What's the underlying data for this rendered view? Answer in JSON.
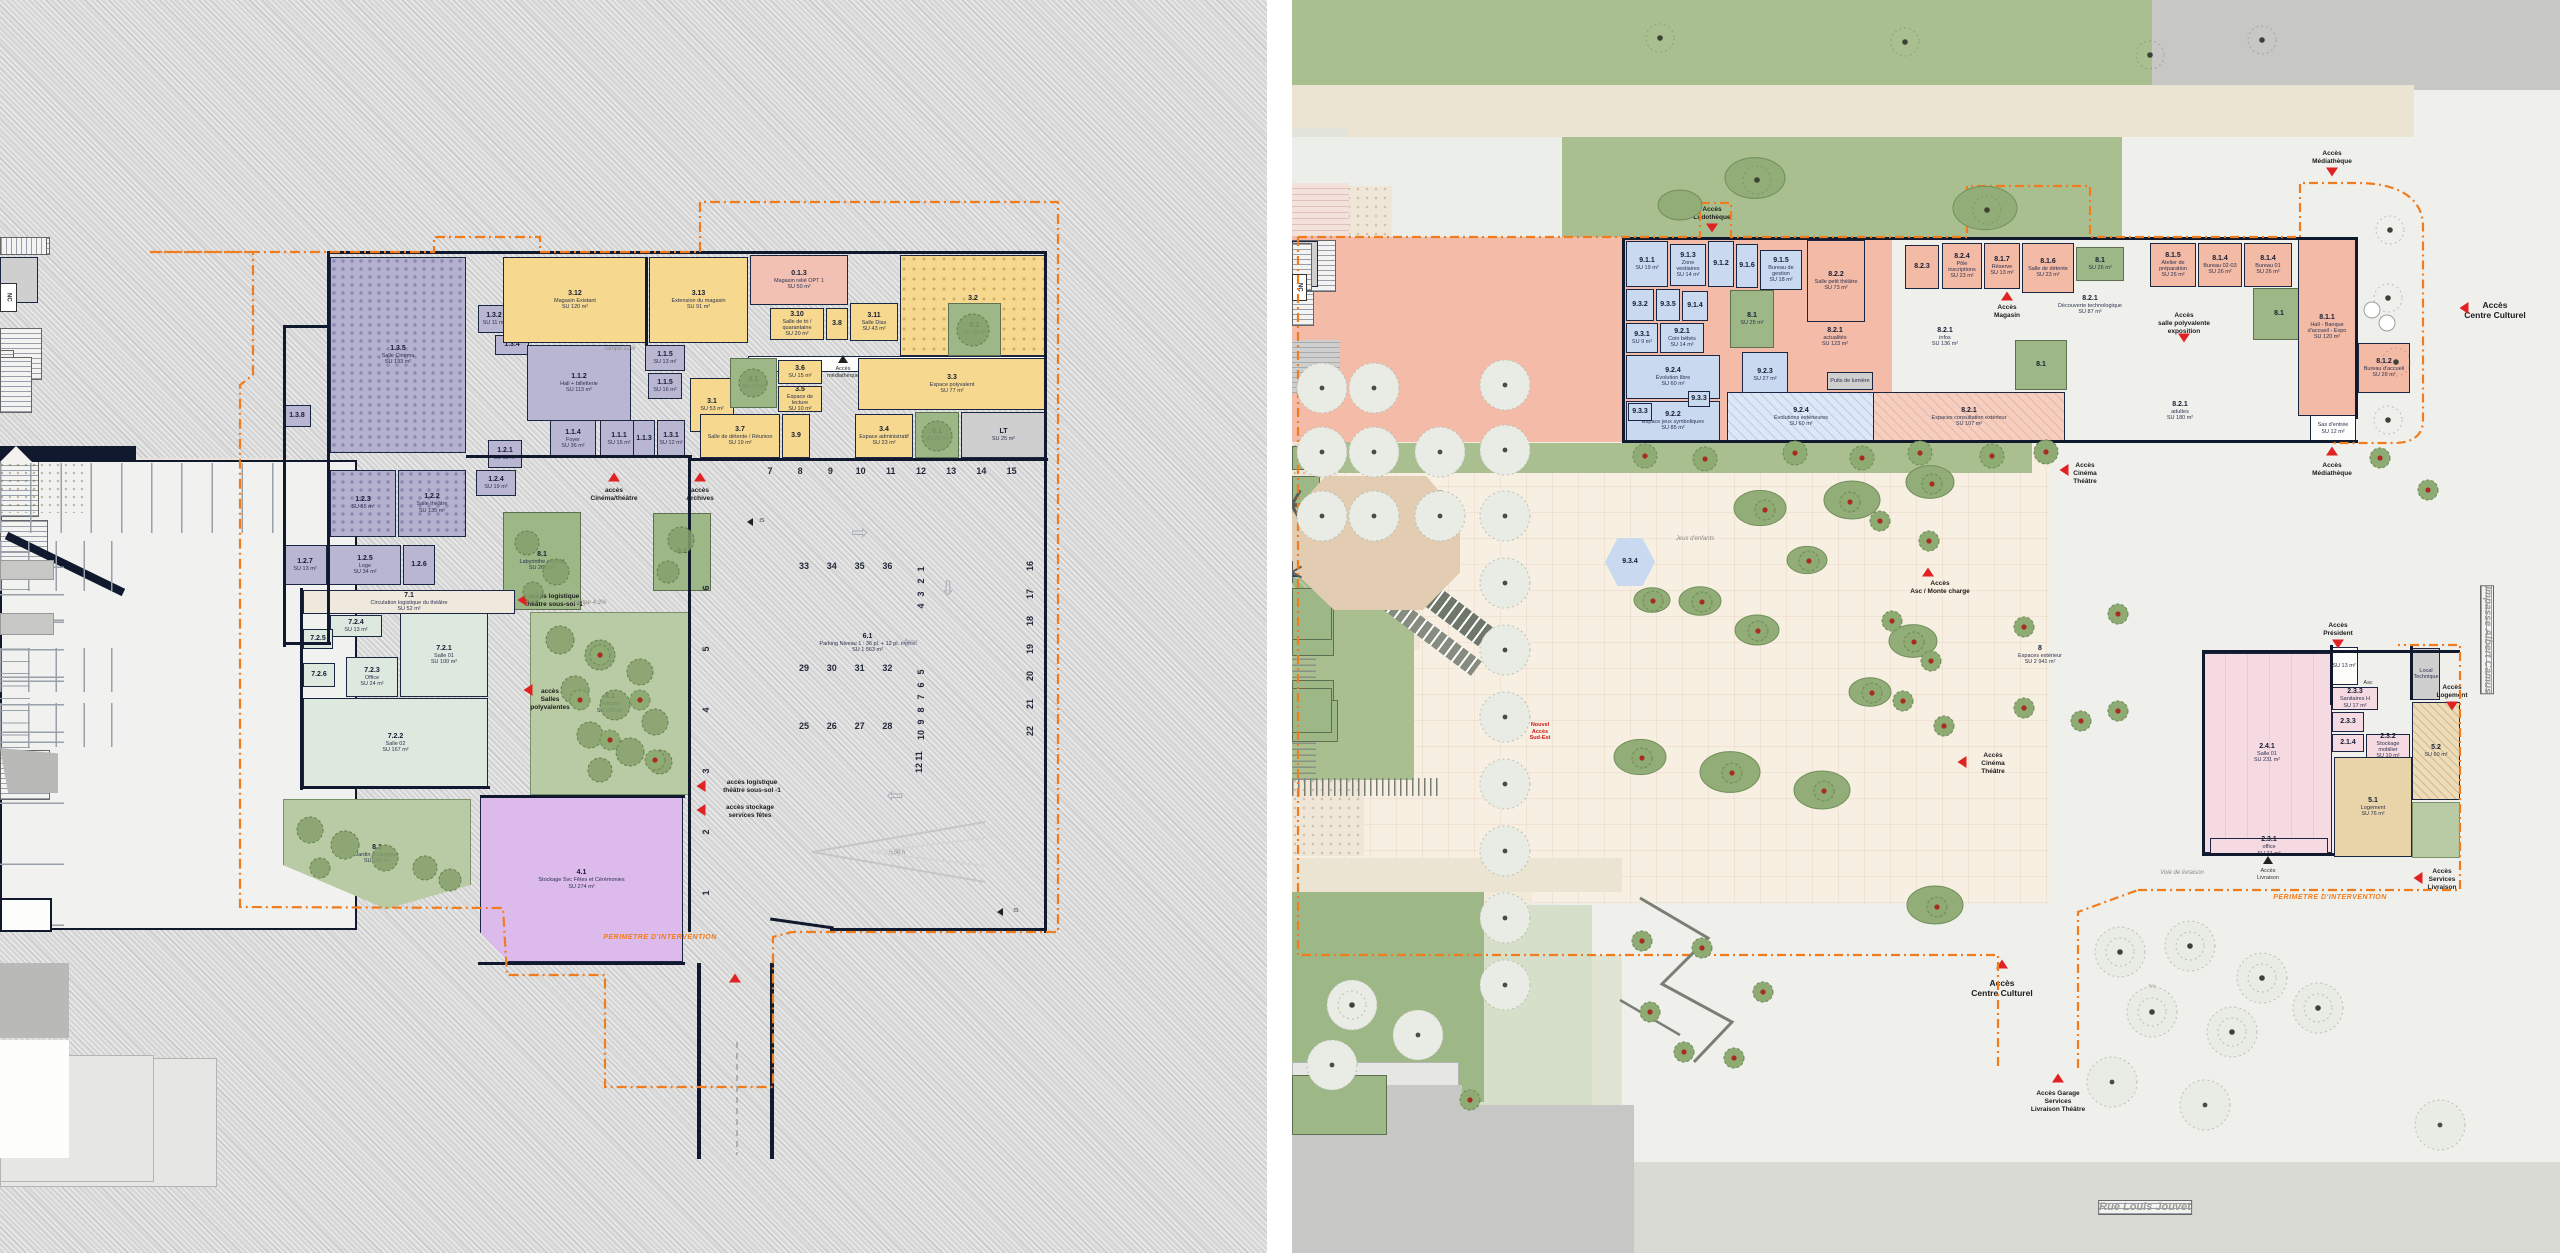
{
  "colors": {
    "accent_orange": "#f07c1e",
    "access_red": "#e02222",
    "wall": "#10192e",
    "purple": "#b9b6d2",
    "yellow": "#f6d88e",
    "salmon": "#f3baa6",
    "blue": "#c9d9f0",
    "green_room": "#dde8de",
    "violet": "#dcbaeb",
    "patio_green": "#9db786",
    "pink": "#f3c1b4"
  },
  "left_plan": {
    "rooms": {
      "r135": {
        "id": "1.3.5",
        "name": "Salle Cinéma",
        "area": "SU 193 m²"
      },
      "r123": {
        "id": "1.2.3",
        "name": "",
        "area": "SU 65 m²"
      },
      "r122": {
        "id": "1.2.2",
        "name": "Salle théâtre",
        "area": "SU 135 m²"
      },
      "r132": {
        "id": "1.3.2",
        "name": "Régie",
        "area": "SU 11 m²"
      },
      "r134": {
        "id": "1.3.4",
        "name": "",
        "area": "SU 11 m²"
      },
      "r138": {
        "id": "1.3.8",
        "name": "",
        "area": "SU 9 m²"
      },
      "r112": {
        "id": "1.1.2",
        "name": "Hall + billetterie",
        "area": "SU 113 m²"
      },
      "r115a": {
        "id": "1.1.5",
        "name": "Vestiaires",
        "area": "SU 13 m²"
      },
      "r115b": {
        "id": "1.1.5",
        "name": "Sanitaires",
        "area": "SU 16 m²"
      },
      "r114": {
        "id": "1.1.4",
        "name": "Foyer",
        "area": "SU 36 m²"
      },
      "r111": {
        "id": "1.1.1",
        "name": "Sas d'entrée",
        "area": "SU 15 m²"
      },
      "r113": {
        "id": "1.1.3",
        "name": "Sanitaires",
        "area": "SU 13 m²"
      },
      "r131": {
        "id": "1.3.1",
        "name": "Bureau association",
        "area": "SU 12 m²"
      },
      "r121": {
        "id": "1.2.1",
        "name": "Sas d'entrée",
        "area": "SU 12 m²"
      },
      "r124": {
        "id": "1.2.4",
        "name": "Régie",
        "area": "SU 19 m²"
      },
      "r127": {
        "id": "1.2.7",
        "name": "Stock",
        "area": "SU 13 m²"
      },
      "r125": {
        "id": "1.2.5",
        "name": "Loge",
        "area": "SU 34 m²"
      },
      "r126": {
        "id": "1.2.6",
        "name": "",
        "area": "SU 9 m²"
      },
      "y312": {
        "id": "3.12",
        "name": "Magasin Existant",
        "area": "SU 120 m²"
      },
      "y313": {
        "id": "3.13",
        "name": "Extension du magasin",
        "area": "SU 91 m²"
      },
      "p013": {
        "id": "0.1.3",
        "name": "Magasin relié OPT 1",
        "area": "SU 50 m²"
      },
      "y310": {
        "id": "3.10",
        "name": "Salle de tri / quarantaine",
        "area": "SU 20 m²"
      },
      "y38": {
        "id": "3.8",
        "name": "Stock / Régie",
        "area": "SU 7 m²"
      },
      "y311": {
        "id": "3.11",
        "name": "Salle Dias",
        "area": "SU 43 m²"
      },
      "y32": {
        "id": "3.2",
        "name": "Espace d'exposition",
        "area": "SU 129 m²"
      },
      "y31": {
        "id": "3.1",
        "name": "",
        "area": "SU 53 m²"
      },
      "y36": {
        "id": "3.6",
        "name": "Bureau",
        "area": "SU 15 m²"
      },
      "y35": {
        "id": "3.5",
        "name": "Espace de lecture",
        "area": "SU 10 m²"
      },
      "y33": {
        "id": "3.3",
        "name": "Espace polyvalent",
        "area": "SU 77 m²"
      },
      "y37": {
        "id": "3.7",
        "name": "Salle de détente / Réunion",
        "area": "SU 19 m²"
      },
      "y39": {
        "id": "3.9",
        "name": "Sanitaires",
        "area": "SU 17 m²"
      },
      "y34": {
        "id": "3.4",
        "name": "Espace administratif",
        "area": "SU 23 m²"
      },
      "glt": {
        "id": "LT",
        "name": "",
        "area": "SU 25 m²"
      },
      "circ": {
        "id": "",
        "name": "Circulation",
        "area": "SU 65 m²"
      },
      "g71": {
        "id": "7.1",
        "name": "Circulation logistique du théâtre",
        "area": "SU 52 m²"
      },
      "g721": {
        "id": "7.2.1",
        "name": "Salle 01",
        "area": "SU 100 m²"
      },
      "g722": {
        "id": "7.2.2",
        "name": "Salle 02",
        "area": "SU 167 m²"
      },
      "g723": {
        "id": "7.2.3",
        "name": "Office",
        "area": "SU 24 m²"
      },
      "g724": {
        "id": "7.2.4",
        "name": "Stockage mobilier",
        "area": "SU 13 m²"
      },
      "g725": {
        "id": "7.2.5",
        "name": "",
        "area": "SU 16 m²"
      },
      "g726": {
        "id": "7.2.6",
        "name": "",
        "area": "SU 14 m²"
      },
      "v41": {
        "id": "4.1",
        "name": "Stockage Svc Fêtes et Cérémonies",
        "area": "SU 274 m²"
      },
      "pa1": {
        "id": "8.1",
        "name": "Patio",
        "area": "SU 27 m²"
      },
      "pa2": {
        "id": "8.1",
        "name": "Patio",
        "area": "SU 26 m²"
      },
      "pa3": {
        "id": "8.1",
        "name": "Patio",
        "area": "SU 25 m²"
      },
      "gar1": {
        "id": "8.1",
        "name": "Labyrinthe végétal",
        "area": "SU 265 m²"
      },
      "gar2": {
        "id": "8.1",
        "name": "",
        "area": ""
      },
      "gar3": {
        "id": "8.1",
        "name": "Pelouse",
        "area": "SU 229 m²"
      },
      "gar4": {
        "id": "8.1",
        "name": "Jardin écologique",
        "area": "SU 162 m²"
      },
      "park": {
        "id": "6.1",
        "name": "Parking Niveau 1 : 36 pl. + 12 pl. motos",
        "area": "SU 1 563 m²"
      }
    },
    "labels": {
      "acces_cinema": "accès\nCinéma/théâtre",
      "acces_archives": "accès\nArchives",
      "acces_log1": "accès logistique\nthéâtre sous-sol -1",
      "acces_salles": "accès\nSalles\npolyvalentes",
      "acces_log2": "accès logistique\nthéâtre sous-sol -1",
      "acces_stockage": "accès stockage\nservices fêtes",
      "acces_med": "Accès\nmédiathèque",
      "perimetre": "PERIMETRE D'INTERVENTION",
      "rampe12": "rampe 12%",
      "rampe43": "rampe 4.3%",
      "is": "IS",
      "nc": "NC",
      "clearance": "5.50 h"
    },
    "parking": {
      "row_top": [
        "7",
        "8",
        "9",
        "10",
        "11",
        "12",
        "13",
        "14",
        "15"
      ],
      "row_33": [
        "33",
        "34",
        "35",
        "36"
      ],
      "row_29": [
        "29",
        "30",
        "31",
        "32"
      ],
      "row_25": [
        "25",
        "26",
        "27",
        "28"
      ],
      "col_left": [
        "6",
        "5",
        "4",
        "3",
        "2",
        "1"
      ],
      "col_right": [
        "16",
        "17",
        "18",
        "19",
        "20",
        "21",
        "22"
      ],
      "moto_a": [
        "1",
        "2",
        "3",
        "4"
      ],
      "moto_b": [
        "5",
        "6",
        "7",
        "8",
        "9",
        "10"
      ],
      "moto_c": [
        "11",
        "12"
      ]
    }
  },
  "right_plan": {
    "rooms": {
      "b911": {
        "id": "9.1.1",
        "name": "",
        "area": "SU 19 m²"
      },
      "b913": {
        "id": "9.1.3",
        "name": "Zone vestiaires",
        "area": "SU 14 m²"
      },
      "b912": {
        "id": "9.1.2",
        "name": "SAS d'entrée",
        "area": "SU 6 m²"
      },
      "b916": {
        "id": "9.1.6",
        "name": "",
        "area": "SU 5 m²"
      },
      "b915": {
        "id": "9.1.5",
        "name": "Bureau de gestion",
        "area": "SU 18 m²"
      },
      "b932": {
        "id": "9.3.2",
        "name": "San. petite enfance",
        "area": "SU 7 m²"
      },
      "b935": {
        "id": "9.3.5",
        "name": "Loc. Mat.",
        "area": "SU 4 m²"
      },
      "b914": {
        "id": "9.1.4",
        "name": "San. PMR",
        "area": "SU 5 m²"
      },
      "b931": {
        "id": "9.3.1",
        "name": "Biberonnerie",
        "area": "SU 9 m²"
      },
      "b921": {
        "id": "9.2.1",
        "name": "Coin bébés",
        "area": "SU 14 m²"
      },
      "b924": {
        "id": "9.2.4",
        "name": "Évolution libre",
        "area": "SU 60 m²"
      },
      "b922": {
        "id": "9.2.2",
        "name": "Espace jeux symboliques",
        "area": "SU 85 m²"
      },
      "b933a": {
        "id": "9.3.3",
        "name": "",
        "area": "SU 5 m²"
      },
      "b933b": {
        "id": "9.3.3",
        "name": "",
        "area": "SU 5 m²"
      },
      "b923": {
        "id": "9.2.3",
        "name": "",
        "area": "SU 27 m²"
      },
      "b924b": {
        "id": "9.2.4",
        "name": "Évolutions extérieures",
        "area": "SU 60 m²"
      },
      "hex934": {
        "id": "9.3.4",
        "name": "Stockage matériels extérieur",
        "area": "SU 12 m²"
      },
      "s822": {
        "id": "8.2.2",
        "name": "Salle petit théâtre",
        "area": "SU 73 m²"
      },
      "s823": {
        "id": "8.2.3",
        "name": "",
        "area": "SU 9 m²"
      },
      "s824": {
        "id": "8.2.4",
        "name": "Pôle inscriptions",
        "area": "SU 23 m²"
      },
      "s817": {
        "id": "8.1.7",
        "name": "Réserve",
        "area": "SU 13 m²"
      },
      "s816": {
        "id": "8.1.6",
        "name": "Salle de détente",
        "area": "SU 23 m²"
      },
      "s821a": {
        "id": "8.2.1",
        "name": "Découverte technologique",
        "area": "SU 87 m²"
      },
      "s821b": {
        "id": "8.2.1",
        "name": "actualités",
        "area": "SU 123 m²"
      },
      "s821c": {
        "id": "8.2.1",
        "name": "infos",
        "area": "SU 136 m²"
      },
      "s821d": {
        "id": "8.2.1",
        "name": "adultes",
        "area": "SU 180 m²"
      },
      "s821e": {
        "id": "8.2.1",
        "name": "Espaces consultation extérieur",
        "area": "SU 107 m²"
      },
      "s815": {
        "id": "8.1.5",
        "name": "Atelier de préparation",
        "area": "SU 26 m²"
      },
      "s814a": {
        "id": "8.1.4",
        "name": "Bureau 02-03",
        "area": "SU 26 m²"
      },
      "s814b": {
        "id": "8.1.4",
        "name": "Bureau 01",
        "area": "SU 26 m²"
      },
      "s811": {
        "id": "8.1.1",
        "name": "Hall - Banque d'accueil - Expo",
        "area": "SU 120 m²"
      },
      "s812": {
        "id": "8.1.2",
        "name": "Bureau d'accueil",
        "area": "SU 26 m²"
      },
      "patL": {
        "id": "8.1",
        "name": "Patio",
        "area": "SU 25 m²"
      },
      "patM": {
        "id": "8.1",
        "name": "Patio",
        "area": "SU 26 m²"
      },
      "patE": {
        "id": "8.1",
        "name": "",
        "area": ""
      },
      "patG": {
        "id": "8.1",
        "name": "",
        "area": ""
      },
      "puits": {
        "id": "",
        "name": "Puits de lumière",
        "area": ""
      },
      "sasS": {
        "id": "",
        "name": "Sas d'entrée",
        "area": "SU 12 m²"
      },
      "esp8": {
        "id": "8",
        "name": "Espaces extérieur",
        "area": "SU 2 941 m²"
      },
      "ph241": {
        "id": "2.4.1",
        "name": "Salle 01",
        "area": "SU 231 m²"
      },
      "s231": {
        "id": "2.3.1",
        "name": "office",
        "area": "SU 21 m²"
      },
      "sasH": {
        "id": "",
        "name": "Sas d'entrée",
        "area": "SU 13 m²"
      },
      "s233a": {
        "id": "2.3.3",
        "name": "Sanitaires H",
        "area": "SU 17 m²"
      },
      "s233b": {
        "id": "2.3.3",
        "name": "Sanitaires F",
        "area": "SU 10 m²"
      },
      "s214": {
        "id": "2.1.4",
        "name": "Local ménage",
        "area": "SU 4 m²"
      },
      "s232": {
        "id": "2.3.2",
        "name": "Stockage mobilier",
        "area": "SU 10 m²"
      },
      "lt": {
        "id": "",
        "name": "Local Technique",
        "area": "SU 13 m²"
      },
      "t51": {
        "id": "5.1",
        "name": "Logement",
        "area": "SU 76 m²"
      },
      "t52": {
        "id": "5.2",
        "name": "Espace extérieur privatif",
        "area": "SU 60 m²"
      }
    },
    "labels": {
      "acc_ludo": "Accès\nLudothèque",
      "acc_mag": "Accès\nMagasin",
      "acc_medN": "Accès\nMédiathèque",
      "acc_medS": "Accès\nMédiathèque",
      "acc_poly": "Accès\nsalle polyvalente\nexposition",
      "acc_cin1": "Accès\nCinéma\nThéâtre",
      "acc_cin2": "Accès\nCinéma\nThéâtre",
      "acc_asc": "Accès\nAsc / Monte charge",
      "acc_ccE": "Accès\nCentre Culturel",
      "acc_ccS": "Accès\nCentre Culturel",
      "acc_garage": "Accès Garage\nServices\nLivraison Théâtre",
      "acc_pres": "Accès\nPrésident",
      "acc_log": "Accès\nLogement",
      "acc_serv": "Accès\nServices\nLivraison",
      "acc_livr": "Accès\nLivraison",
      "voie": "Voie de livraison",
      "nouvel": "Nouvel\nAccès\nSud-Est",
      "jeux": "Jeux d'enfants",
      "rue": "Rue Louis Jouvet",
      "impasse": "Impasse Albert Camus",
      "perimetre": "PERIMETRE D'INTERVENTION",
      "asc": "Asc",
      "pente2": "2%"
    }
  }
}
